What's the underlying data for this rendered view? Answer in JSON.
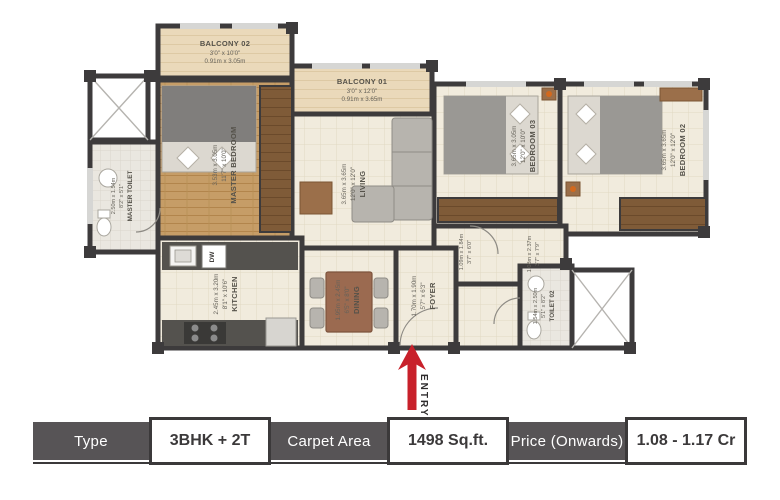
{
  "plan": {
    "entry_label": "ENTRY",
    "rooms": {
      "balcony_02": {
        "name": "BALCONY 02",
        "ft": "3'0\" x 10'0\"",
        "m": "0.91m x 3.05m"
      },
      "balcony_01": {
        "name": "BALCONY 01",
        "ft": "3'0\" x 12'0\"",
        "m": "0.91m x 3.65m"
      },
      "master_bedroom": {
        "name": "MASTER BEDROOM",
        "ft": "11'7\" x 10'0\"",
        "m": "3.53m x 3.05m"
      },
      "master_toilet": {
        "name": "MASTER TOILET",
        "ft": "8'2\" x 5'1\"",
        "m": "2.50m x 1.54m"
      },
      "living": {
        "name": "LIVING",
        "ft": "12'0\" x 12'0\"",
        "m": "3.65m x 3.65m"
      },
      "bedroom_03": {
        "name": "BEDROOM 03",
        "ft": "12'0\" x 10'0\"",
        "m": "3.65m x 3.05m"
      },
      "bedroom_02": {
        "name": "BEDROOM 02",
        "ft": "12'0\" x 12'0\"",
        "m": "3.65m x 3.65m"
      },
      "kitchen": {
        "name": "KITCHEN",
        "ft": "8'1\" x 10'6\"",
        "m": "2.45m x 3.20m"
      },
      "dining": {
        "name": "DINING",
        "ft": "6'5\" x 8'0\"",
        "m": "1.95m x 2.45m"
      },
      "foyer": {
        "name": "FOYER",
        "ft": "5'7\" x 6'3\"",
        "m": "1.70m x 1.90m"
      },
      "toilet_02": {
        "name": "TOILET 02",
        "ft": "5'1\" x 8'2\"",
        "m": "1.54m x 2.50m"
      }
    },
    "passages": {
      "passage_1": {
        "ft": "3'7\" x 6'0\"",
        "m": "1.09m x 1.84m"
      },
      "passage_2": {
        "ft": "3'7\" x 7'9\"",
        "m": "1.08m x 2.37m"
      }
    },
    "appliances": {
      "dishwasher": "DW"
    }
  },
  "spec_table": {
    "type_label": "Type",
    "type_value": "3BHK + 2T",
    "carpet_label": "Carpet Area",
    "carpet_value": "1498 Sq.ft.",
    "price_label": "Price (Onwards)",
    "price_value": "1.08 - 1.17 Cr"
  },
  "colors": {
    "wall": "#3d3b3c",
    "accent_red": "#c8202a",
    "table_label_bg": "#575456",
    "floor_beige": "#f1ebdd",
    "wood": "#c69d67"
  }
}
